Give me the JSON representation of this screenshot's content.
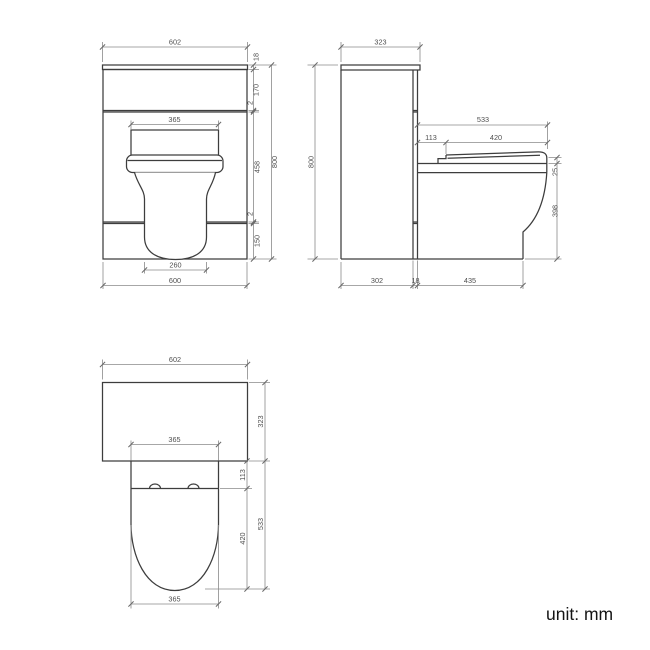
{
  "colors": {
    "background": "#ffffff",
    "object_line": "#3d3d3d",
    "dimension_line": "#8a8a8a",
    "dimension_text": "#4f4f4f",
    "note_text": "#141414"
  },
  "footer": {
    "unit_label": "unit: mm"
  },
  "views": {
    "front": {
      "name": "front-elevation",
      "dims": {
        "worktop_width": "602",
        "worktop_thickness": "18",
        "drawer_front_height": "170",
        "gap_upper": "2",
        "mid_panel_height": "458",
        "gap_lower": "2",
        "plinth_height": "150",
        "overall_height": "800",
        "cistern_panel_width": "365",
        "bowl_base_width": "260",
        "cabinet_width": "600"
      }
    },
    "side": {
      "name": "side-elevation",
      "dims": {
        "worktop_depth": "323",
        "overall_height": "800",
        "seat_overall_depth": "533",
        "seat_back_offset": "113",
        "seat_depth": "420",
        "seat_thickness": "25",
        "pan_height": "398",
        "cabinet_body_depth": "302",
        "back_panel_gap": "18",
        "pan_projection": "435"
      }
    },
    "plan": {
      "name": "plan-view",
      "dims": {
        "worktop_width": "602",
        "worktop_depth": "323",
        "seat_width_back": "365",
        "hinge_offset": "113",
        "seat_length": "420",
        "overall_projection": "533",
        "seat_width_front": "365"
      }
    }
  }
}
